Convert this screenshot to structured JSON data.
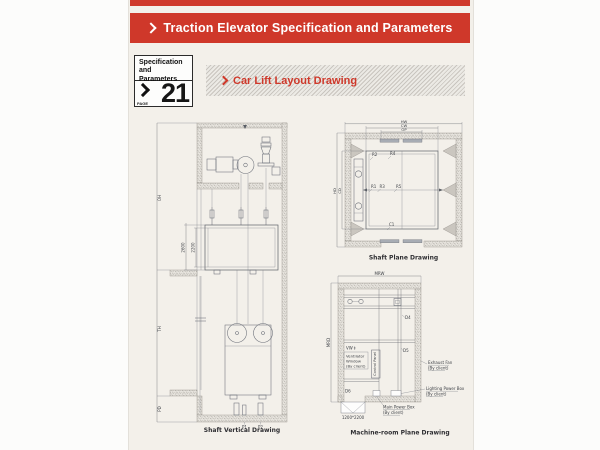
{
  "banner": {
    "title": "Traction Elevator Specification and Parameters"
  },
  "icons": {
    "chevron": "css-right-chevron",
    "updown_arrow": "↕"
  },
  "page_tab": {
    "line1": "Specification",
    "line2": "and Parameters",
    "page_label": "PAGE",
    "page_number": "21"
  },
  "section": {
    "title": "Car Lift Layout Drawing"
  },
  "shaft_vertical": {
    "caption": "Shaft Vertical Drawing",
    "dims": {
      "overhead": "OH",
      "travel": "TH",
      "pit": "PD",
      "car_outer": "2600",
      "car_inner": "2200"
    },
    "buffers": {
      "p1": "P1",
      "p2": "P2"
    }
  },
  "shaft_plane": {
    "caption": "Shaft Plane Drawing",
    "dims": {
      "hoistway_width": "HW",
      "car_width": "CW",
      "opening": "OP",
      "hoistway_depth": "HD",
      "car_depth": "CD"
    },
    "refs": {
      "r1": "R1",
      "r2": "R2",
      "r3": "R3",
      "r4": "R4",
      "r5": "R5",
      "c1": "C1"
    }
  },
  "machine_room": {
    "caption": "Machine-room Plane Drawing",
    "dims": {
      "width": "MRW",
      "depth": "MRD"
    },
    "refs": {
      "d4": "D4",
      "d5": "D5",
      "d6": "D6",
      "vw": "VW"
    },
    "labels": {
      "ventilator_line1": "Ventilator",
      "ventilator_line2": "Window",
      "by_client": "(By client)",
      "control_panel": "Control Panel",
      "exhaust_fan": "Exhaust Fan",
      "lighting_power_box": "Lighting Power Box",
      "main_power_box": "Main Power Box",
      "door_size": "1200*2200"
    }
  },
  "colors": {
    "accent_red": "#cf382a",
    "drawing_line": "#6b6f78",
    "page_bg": "#f3f0ea"
  }
}
